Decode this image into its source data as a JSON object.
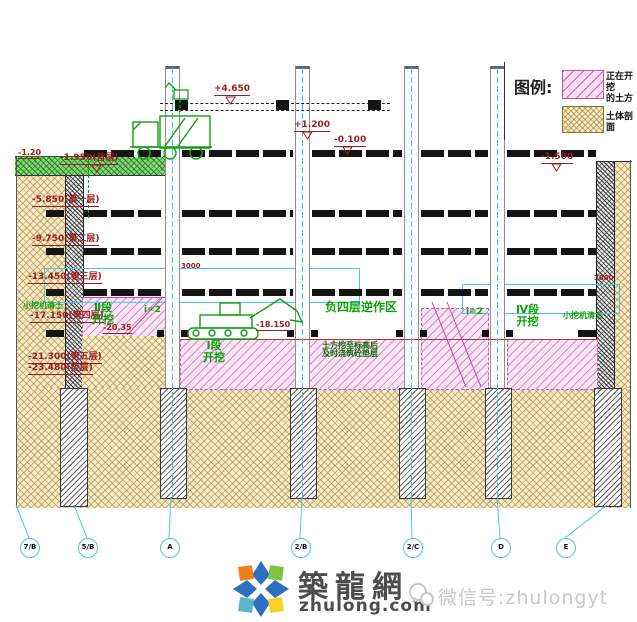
{
  "legend": {
    "title": "图例:",
    "items": [
      {
        "key": "excavating",
        "label": "正在开挖\n的土方"
      },
      {
        "key": "soil-section",
        "label": "土体剖面"
      }
    ]
  },
  "colors": {
    "annotation_red": "#9b1d1d",
    "annotation_green": "#0ca00c",
    "axis_cyan": "#49c8d8",
    "excavation_pink": "#fae7f5",
    "pink_hatch": "#cc3fa8",
    "soil_tan": "#f6ecca",
    "ground_green": "#8ad47e"
  },
  "labels": {
    "elevations": [
      {
        "text": "-1.20",
        "x": 18,
        "y": 149,
        "size": 8
      },
      {
        "text": "-1.950(首层)",
        "x": 60,
        "y": 154,
        "size": 9
      },
      {
        "text": "+4.650",
        "x": 214,
        "y": 85,
        "size": 9
      },
      {
        "text": "+1.200",
        "x": 294,
        "y": 121,
        "size": 9
      },
      {
        "text": "-0.100",
        "x": 334,
        "y": 136,
        "size": 9
      },
      {
        "text": "-1.500",
        "x": 541,
        "y": 153,
        "size": 9
      },
      {
        "text": "-5.850(第一层)",
        "x": 32,
        "y": 196,
        "size": 9
      },
      {
        "text": "-9.750(第二层)",
        "x": 32,
        "y": 235,
        "size": 9
      },
      {
        "text": "-13.450(第三层)",
        "x": 28,
        "y": 273,
        "size": 9
      },
      {
        "text": "-17.150(第四层)",
        "x": 30,
        "y": 312,
        "size": 9
      },
      {
        "text": "-20.35",
        "x": 103,
        "y": 324,
        "size": 8
      },
      {
        "text": "-18.150",
        "x": 256,
        "y": 321,
        "size": 8
      },
      {
        "text": "-21.300(第五层)",
        "x": 28,
        "y": 353,
        "size": 9
      },
      {
        "text": "-23.480(垫层)",
        "x": 28,
        "y": 364,
        "size": 9
      }
    ],
    "dimensions": [
      {
        "text": "3000",
        "x": 181,
        "y": 263,
        "size": 7
      },
      {
        "text": "3000",
        "x": 594,
        "y": 275,
        "size": 7
      }
    ],
    "zones": [
      {
        "text": "Ⅱ段\n开挖",
        "x": 92,
        "y": 302,
        "size": 11,
        "dark": false
      },
      {
        "text": "Ⅰ段\n开挖",
        "x": 203,
        "y": 340,
        "size": 11,
        "dark": false
      },
      {
        "text": "Ⅳ段\n开挖",
        "x": 516,
        "y": 304,
        "size": 11,
        "dark": false
      },
      {
        "text": "负四层逆作区",
        "x": 325,
        "y": 301,
        "size": 12,
        "dark": false
      },
      {
        "text": "土方挖至标高后\n及时浇筑砼垫层",
        "x": 322,
        "y": 342,
        "size": 8,
        "dark": true
      },
      {
        "text": "小挖机清土",
        "x": 23,
        "y": 302,
        "size": 8,
        "dark": false
      },
      {
        "text": "小挖机清土",
        "x": 563,
        "y": 312,
        "size": 8,
        "dark": false
      },
      {
        "text": "i=2",
        "x": 144,
        "y": 306,
        "size": 9,
        "dark": false
      },
      {
        "text": "i=2",
        "x": 466,
        "y": 308,
        "size": 9,
        "dark": false
      }
    ]
  },
  "axes": {
    "cy": 538,
    "bubbles": [
      {
        "label": "7/B",
        "cx": 29
      },
      {
        "label": "5/B",
        "cx": 87
      },
      {
        "label": "A",
        "cx": 169
      },
      {
        "label": "2/B",
        "cx": 300
      },
      {
        "label": "2/C",
        "cx": 412
      },
      {
        "label": "D",
        "cx": 500
      },
      {
        "label": "E",
        "cx": 565
      }
    ],
    "leaders": [
      [
        16,
        505,
        29,
        538
      ],
      [
        74,
        505,
        87,
        538
      ],
      [
        171,
        497,
        169,
        538
      ],
      [
        302,
        497,
        300,
        538
      ],
      [
        411,
        497,
        412,
        538
      ],
      [
        497,
        497,
        500,
        538
      ],
      [
        607,
        505,
        565,
        538
      ]
    ]
  },
  "drawing": {
    "column_top": 66,
    "column_bottom": 389,
    "column_w": 13,
    "columns": [
      {
        "x": 165
      },
      {
        "x": 295
      },
      {
        "x": 404
      },
      {
        "x": 490
      }
    ],
    "centerlines": [
      172,
      302,
      411,
      497
    ],
    "piles": [
      {
        "x": 60,
        "y": 388,
        "w": 26,
        "h": 117
      },
      {
        "x": 160,
        "y": 388,
        "w": 25,
        "h": 109
      },
      {
        "x": 290,
        "y": 388,
        "w": 25,
        "h": 109
      },
      {
        "x": 399,
        "y": 388,
        "w": 25,
        "h": 109
      },
      {
        "x": 485,
        "y": 388,
        "w": 25,
        "h": 109
      },
      {
        "x": 594,
        "y": 388,
        "w": 26,
        "h": 117
      }
    ],
    "slab_levels": [
      {
        "y": 150,
        "segs": [
          [
            84,
            163
          ],
          [
            182,
            293
          ],
          [
            312,
            402
          ],
          [
            421,
            488
          ],
          [
            507,
            596
          ]
        ]
      },
      {
        "y": 210,
        "segs": [
          [
            46,
            64
          ],
          [
            84,
            163
          ],
          [
            182,
            293
          ],
          [
            312,
            402
          ],
          [
            421,
            488
          ],
          [
            507,
            596
          ]
        ]
      },
      {
        "y": 248,
        "segs": [
          [
            46,
            64
          ],
          [
            84,
            163
          ],
          [
            182,
            293
          ],
          [
            312,
            402
          ],
          [
            421,
            488
          ],
          [
            507,
            596
          ]
        ]
      },
      {
        "y": 289,
        "segs": [
          [
            46,
            64
          ],
          [
            84,
            163
          ],
          [
            182,
            293
          ],
          [
            312,
            402
          ],
          [
            421,
            488
          ],
          [
            507,
            596
          ]
        ]
      },
      {
        "y": 330,
        "segs": [
          [
            46,
            64
          ],
          [
            157,
            164
          ],
          [
            181,
            188
          ],
          [
            287,
            294
          ],
          [
            311,
            318
          ],
          [
            396,
            403
          ],
          [
            420,
            427
          ],
          [
            482,
            489
          ],
          [
            506,
            513
          ],
          [
            578,
            596
          ]
        ]
      }
    ]
  },
  "watermark": {
    "site_name": "築龍網",
    "site_url": "zhulong.com",
    "wechat": "微信号:zhulongyt"
  }
}
